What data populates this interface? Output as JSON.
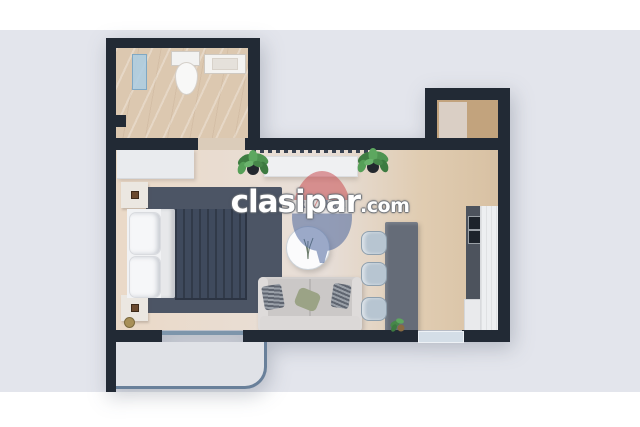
{
  "watermark": {
    "brand": "clasipar",
    "suffix": ".com",
    "balloon_left": "RE",
    "balloon_slash": "/",
    "balloon_right": "MAX"
  },
  "colors": {
    "field": "#e3e5ec",
    "wall": "#222a35",
    "bath_floor": "#dcc8b0",
    "threshold": "#dbccba",
    "floor_a": "#ead9c7",
    "floor_b": "#e9ddd2",
    "floor_tan": "#d8c1a3",
    "closet_floor": "#c2a37d",
    "washer": "#dacfc5",
    "balcony": "#e0e2e7",
    "railing": "#69809a",
    "glass": "#7d95ab",
    "rug": "#4c5565",
    "duvet": "#3f4a5d",
    "sheet": "#e7e8ea",
    "pillow": "#f1f2f4",
    "wardrobe": "#e9ebee",
    "nightstand": "#ebe7e1",
    "gold": "#a89058",
    "sofa": "#d2cfce",
    "sofa_light": "#dedbda",
    "sage": "#9ba386",
    "stripe_dark": "#5f6570",
    "stripe_light": "#9aa0a8",
    "island": "#656c78",
    "stool": "#b7c5d1",
    "stool_border": "#8fa0ae",
    "counter_dark": "#4d535d",
    "burner": "#1d232b",
    "cabinet": "#e9eaec",
    "fridge": "#edeff1",
    "remax_red": "#c8474c",
    "remax_blue": "#44609a",
    "remax_navy": "#27406e",
    "wm_fill": "#ffffff",
    "wm_outline": "#6a6f76"
  }
}
